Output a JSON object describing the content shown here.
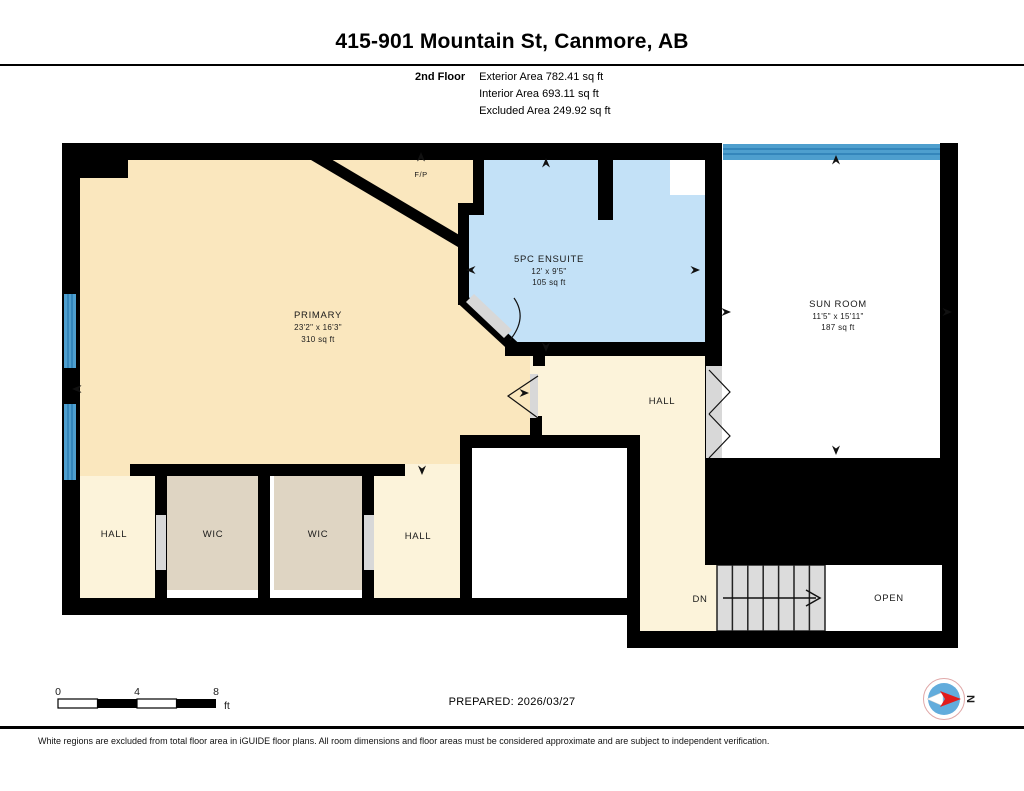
{
  "header": {
    "title": "415-901 Mountain St, Canmore, AB",
    "floor_label": "2nd Floor",
    "exterior_area": "Exterior Area 782.41 sq ft",
    "interior_area": "Interior Area 693.11 sq ft",
    "excluded_area": "Excluded Area 249.92 sq ft"
  },
  "rooms": {
    "primary": {
      "name": "PRIMARY",
      "dims": "23'2\" x 16'3\"",
      "area": "310 sq ft"
    },
    "ensuite": {
      "name": "5PC ENSUITE",
      "dims": "12' x 9'5\"",
      "area": "105 sq ft"
    },
    "sunroom": {
      "name": "SUN ROOM",
      "dims": "11'5\" x 15'11\"",
      "area": "187 sq ft"
    },
    "hall_mid": {
      "name": "HALL"
    },
    "hall_left": {
      "name": "HALL"
    },
    "wic_left": {
      "name": "WIC"
    },
    "wic_right": {
      "name": "WIC"
    },
    "hall_right": {
      "name": "HALL"
    },
    "stairs": {
      "name": "DN"
    },
    "open": {
      "name": "OPEN"
    },
    "fireplace": {
      "name": "F/P"
    }
  },
  "scale_bar": {
    "tick0": "0",
    "tick4": "4",
    "tick8": "8",
    "unit": "ft"
  },
  "footer": {
    "prepared": "PREPARED: 2026/03/27",
    "compass_north": "N",
    "disclaimer": "White regions are excluded from total floor area in iGUIDE floor plans. All room dimensions and floor areas must be considered approximate and are subject to independent verification."
  },
  "colors": {
    "wall": "#000000",
    "floor_primary": "#FAE7BE",
    "floor_hall": "#FCF3DA",
    "floor_wic": "#DFD5C3",
    "floor_ensuite": "#C3E1F7",
    "window_blue": "#4E9FCE",
    "window_line": "#1B6CA8",
    "door_gray": "#D8D8D8",
    "stair_gray": "#DCDCDC",
    "excluded_white": "#FFFFFF",
    "compass_red": "#E21B1B",
    "compass_blue": "#62ACDC"
  }
}
